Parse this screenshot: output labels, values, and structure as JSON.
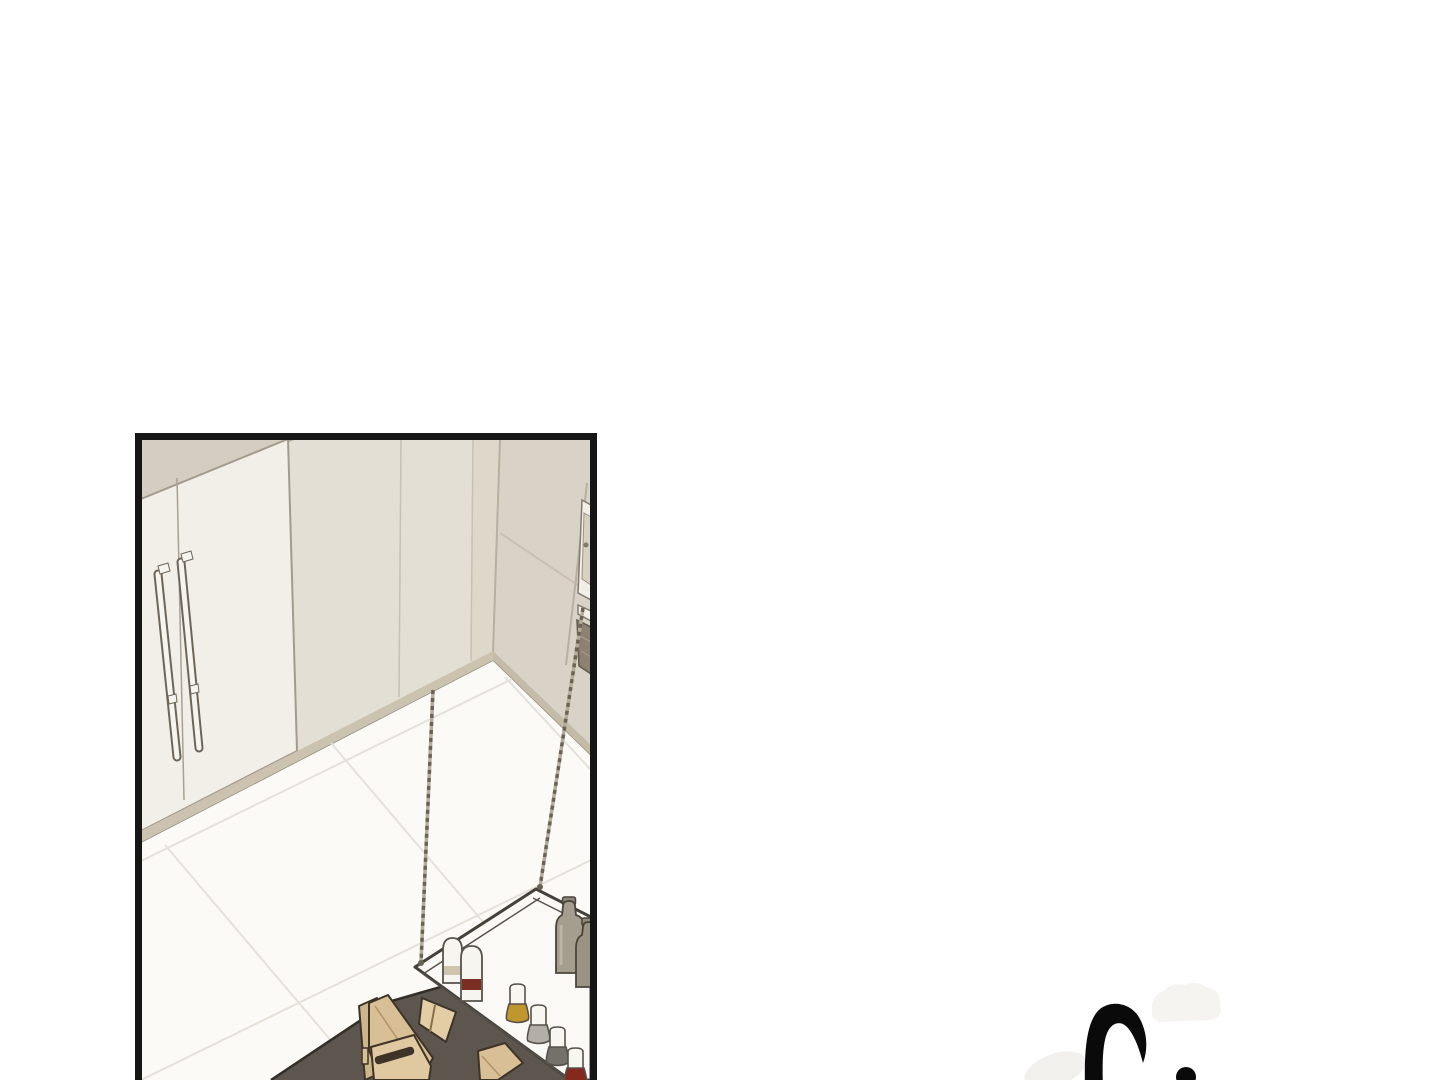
{
  "page": {
    "kind": "webtoon page",
    "background": "#ffffff"
  },
  "panel": {
    "description": "kitchen corner scene: refrigerator, cabinets, built-in oven, tiled floor, dark counter island with wooden boards, wire-suspended shelf with bottles",
    "objects": [
      "refrigerator with double doors and two vertical bar handles",
      "cream cabinet wall panels",
      "built-in wall oven (partially cropped)",
      "white diagonal-tiled floor",
      "dark counter island",
      "wooden cutting boards in rack",
      "wooden stand wedge",
      "flat wooden board",
      "wire-suspended white shelf",
      "two white canisters with bands",
      "four spice jars (gold, gray, dark gray, red)",
      "two olive glass bottles"
    ]
  },
  "sfx": {
    "glyph": "partial handwritten brush-stroke sound effect, cropped at page bottom",
    "ink": "#0a0a0a"
  },
  "palette": {
    "page_bg": "#ffffff",
    "panel_border": "#161616",
    "wall_base": "#e7e2d8",
    "ceiling": "#d4cec2",
    "cabinet": "#e4dfd4",
    "cabinet_corner": "#ded8cb",
    "right_wall": "#d9d3c7",
    "fridge": "#f2efe8",
    "handle": "#f6f4ee",
    "handle_outline": "#6d6557",
    "seam": "#c8c0b2",
    "baseboard_left": "#cbc3b0",
    "baseboard_right": "#c4bba8",
    "baseboard_line": "#948c7a",
    "floor": "#fbfaf7",
    "grout": "#e5e1da",
    "counter": "#5c564e",
    "counter_edge": "#322d27",
    "shelf": "#fbf9f5",
    "shelf_outline": "#45403a",
    "rod": "#6a6253",
    "rod_base": "#b5ad9c",
    "canister": "#f7f5f0",
    "canister_band_tan": "#cfc4ad",
    "canister_band_red": "#7b2d22",
    "olive_bottle": "#a59d8e",
    "olive_bottle2": "#9a9283",
    "olive_cap": "#8f8778",
    "jar_top": "#f8f6f1",
    "jar_gold": "#c0962e",
    "jar_gray": "#b3afa7",
    "jar_darkgray": "#74706a",
    "jar_red": "#85281d",
    "wood": "#d8bf95",
    "wood_light": "#e0c9a0",
    "wood_back": "#cdb68c",
    "wood_wedge": "#e3cda5",
    "wood_edge": "#b2946a",
    "wood_dark": "#3e3327",
    "oven_frame": "#f2efe8",
    "oven_inner": "#d8d1c2",
    "oven_window": "#8d8172",
    "sfx_ink": "#0a0a0a",
    "sfx_faint": "#f5f4f1",
    "sfx_faint2": "#f1f0ed"
  }
}
